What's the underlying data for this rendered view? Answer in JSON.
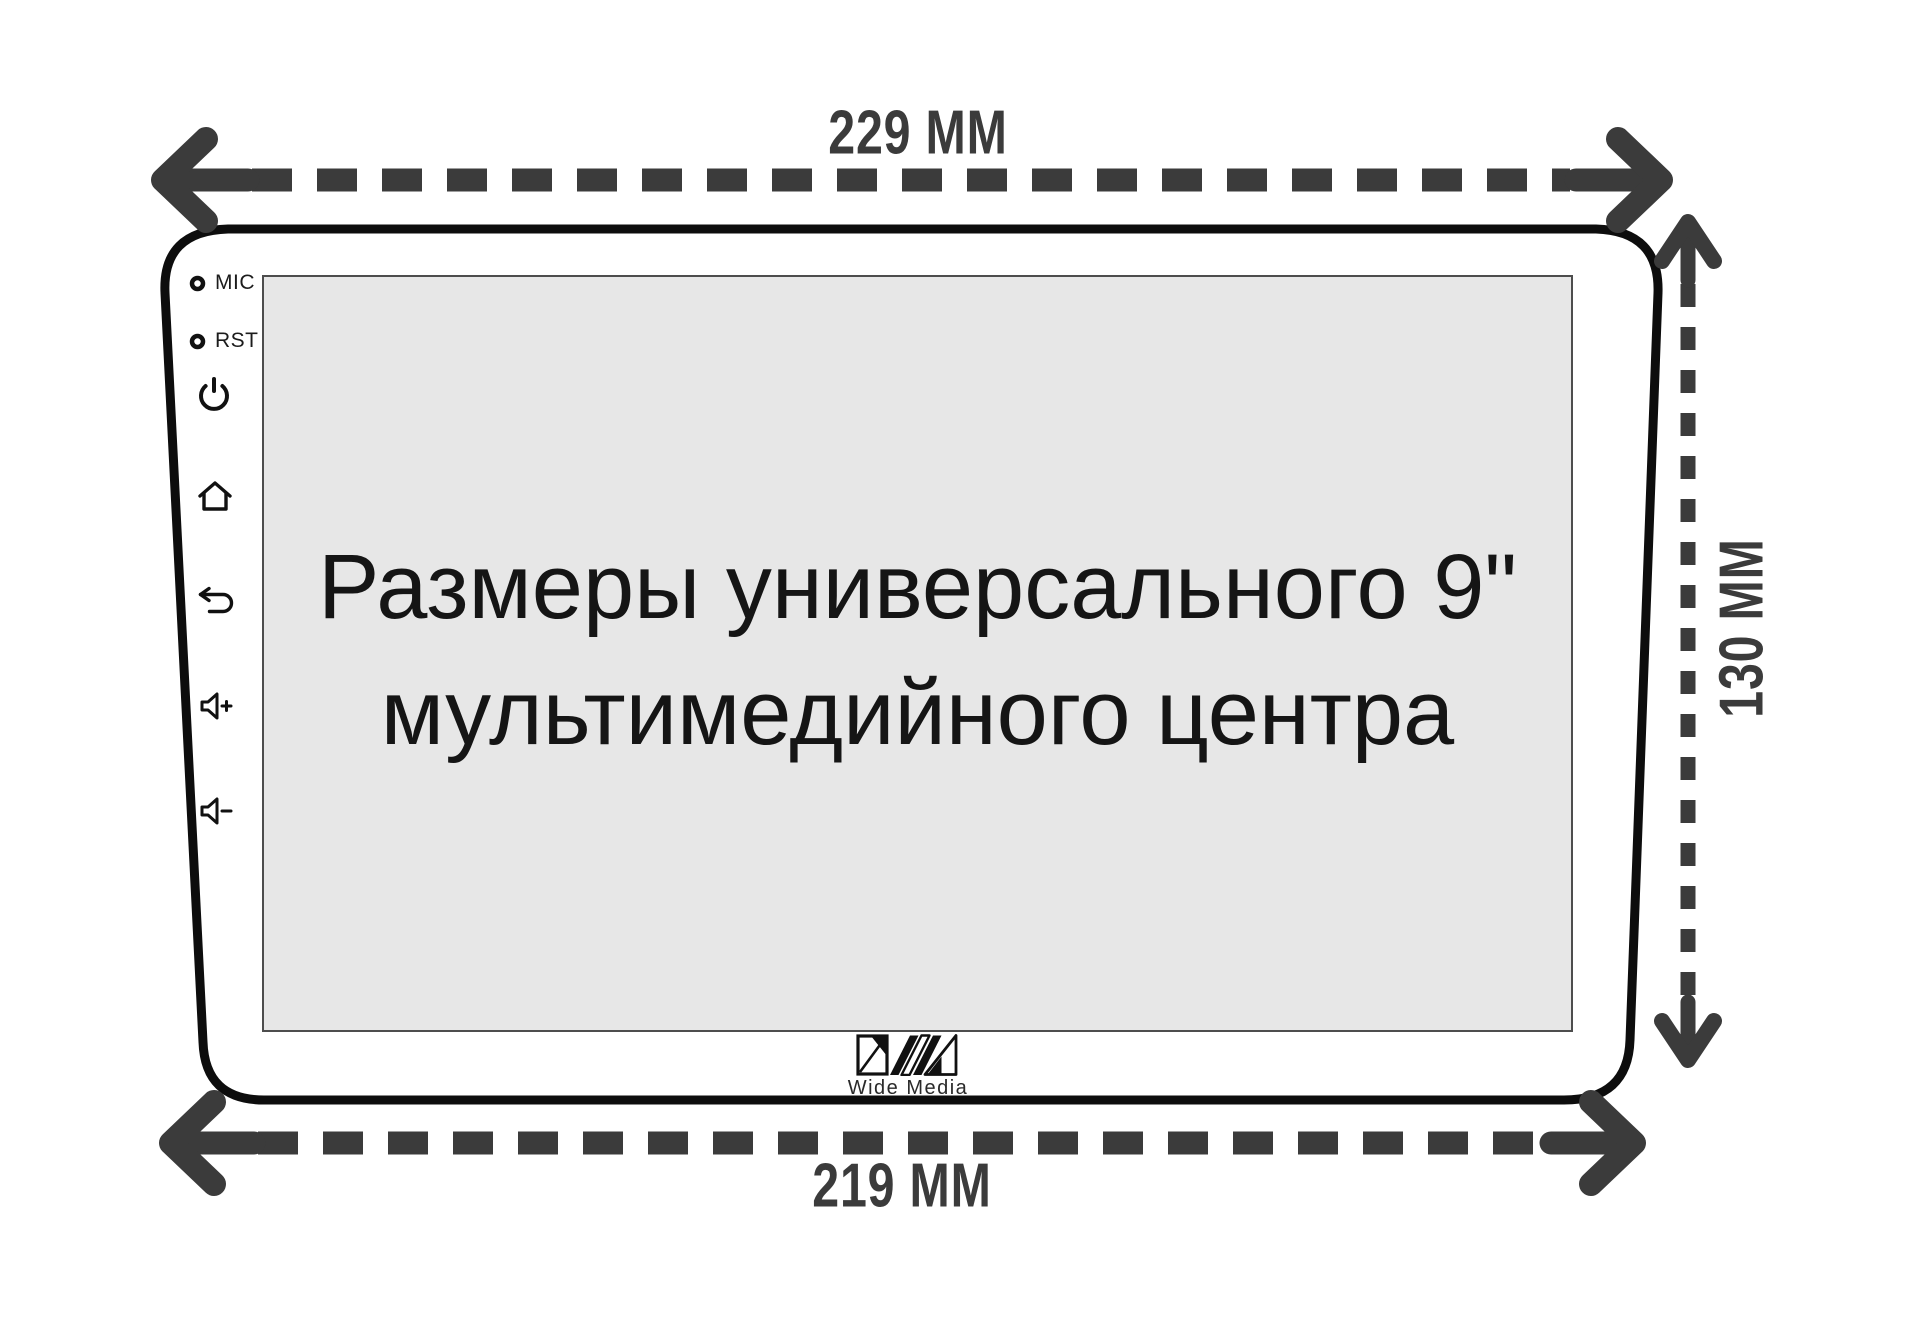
{
  "dimensions": {
    "width_top": "229 MM",
    "width_bottom": "219 MM",
    "height_right": "130 MM"
  },
  "screen": {
    "line1": "Размеры универсального 9\"",
    "line2": "мультимедийного центра"
  },
  "side_controls": {
    "mic_label": "MIC",
    "rst_label": "RST",
    "icons": [
      "mic-hole-icon",
      "reset-hole-icon",
      "power-icon",
      "home-icon",
      "back-icon",
      "volume-up-icon",
      "volume-down-icon"
    ]
  },
  "logo": {
    "text": "Wide Media"
  },
  "colors": {
    "arrow": "#3b3b3b",
    "outline": "#0d0d0d",
    "screen_fill": "#e7e7e7",
    "screen_border": "#4d4d4d",
    "icon": "#111111",
    "background": "#ffffff"
  }
}
